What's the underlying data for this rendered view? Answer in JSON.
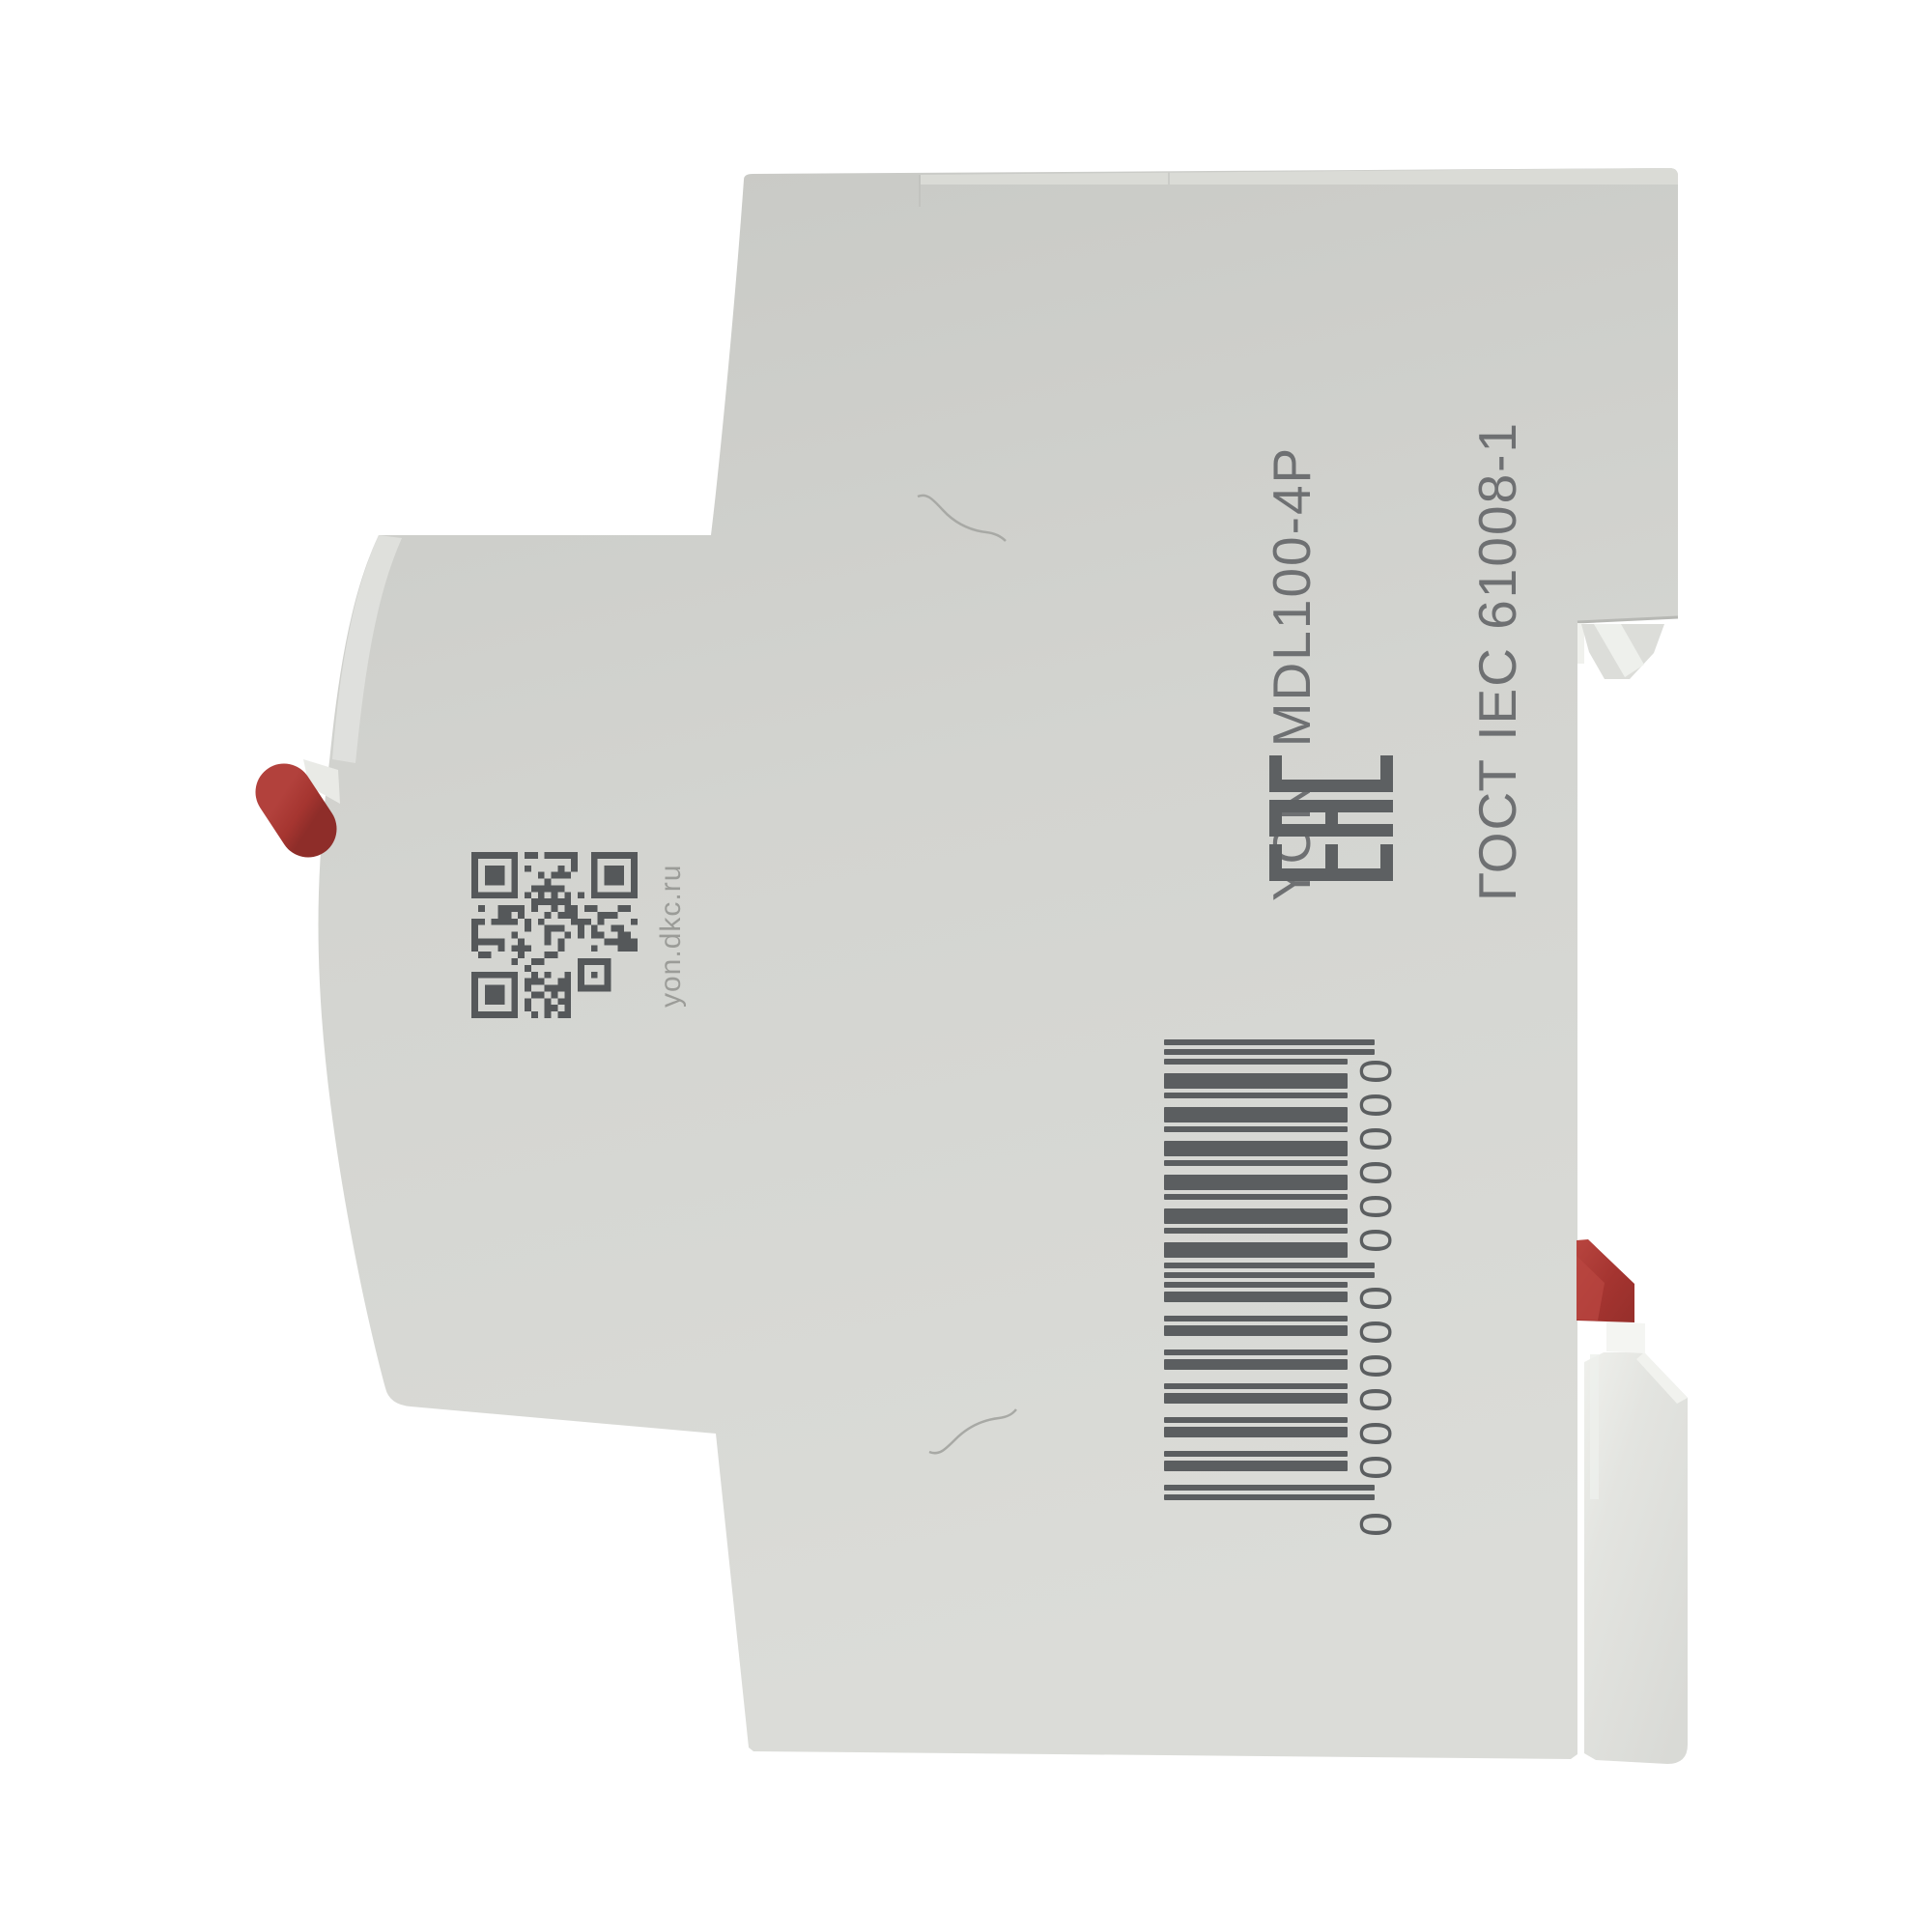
{
  "product": {
    "label": {
      "line1": "YON  MDL100-4P",
      "line2": "ГОСТ IEC 61008-1"
    },
    "qr": {
      "caption": "yon.dkc.ru",
      "modules": 25
    },
    "certification_mark": "EAC",
    "barcode": {
      "digits": "0000000000000",
      "display": "0 000000 000000"
    },
    "colors": {
      "body_top": "#c7c8c4",
      "body_mid": "#d3d4d0",
      "body_bottom": "#dcddd9",
      "marking_dark": "#55585a",
      "label_text": "#6e7072",
      "caption_text": "#9b9c98",
      "barcode_ink": "#5b5e60",
      "toggle_red": "#a63732",
      "toggle_red_dark": "#8e2d29",
      "clip_red": "#a93733",
      "highlight_white": "#f3f4f1"
    }
  }
}
